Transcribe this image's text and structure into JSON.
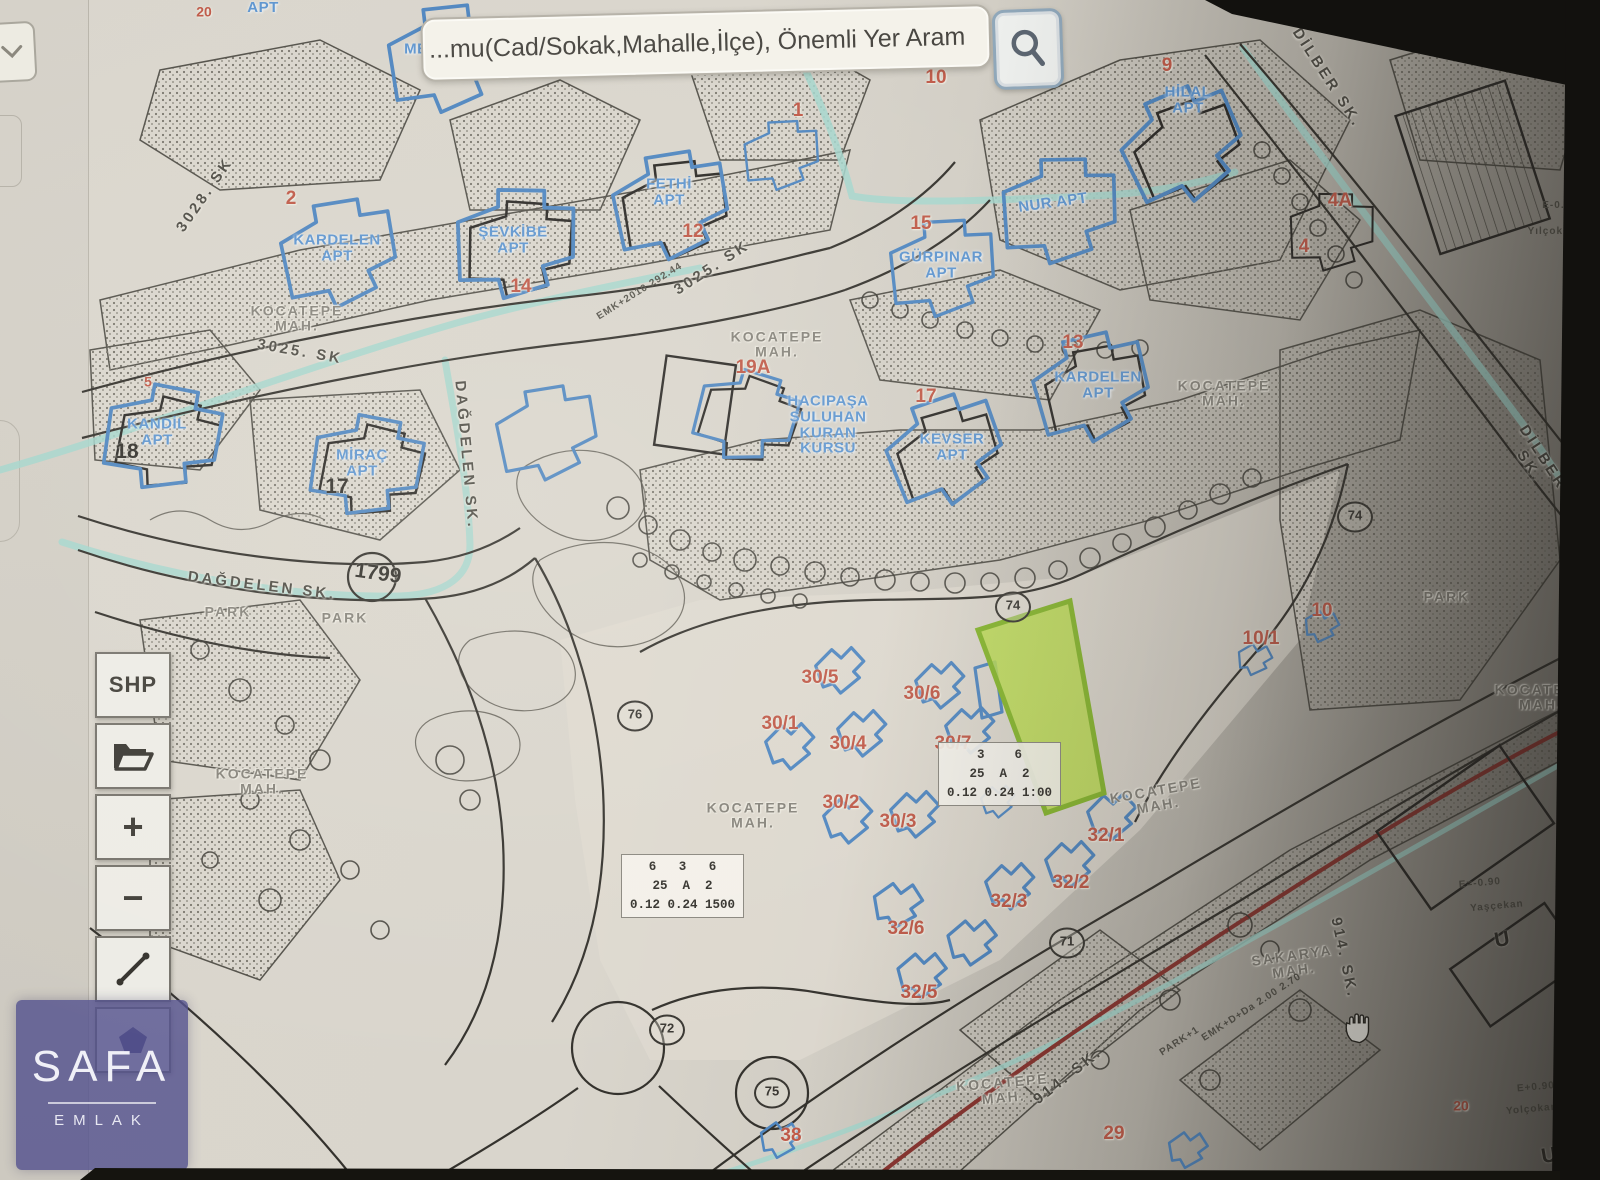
{
  "search": {
    "value": "...mu(Cad/Sokak,Mahalle,İlçe), Önemli Yer Aram",
    "button_icon": "magnifier-icon"
  },
  "corner_button": {
    "icon": "chevron-down-icon"
  },
  "toolbar": {
    "buttons": [
      {
        "id": "shp",
        "label": "SHP"
      },
      {
        "id": "open-layer",
        "icon": "folder-icon"
      },
      {
        "id": "zoom-in",
        "label": "+"
      },
      {
        "id": "zoom-out",
        "label": "−"
      },
      {
        "id": "measure",
        "icon": "ruler-icon"
      },
      {
        "id": "draw-polygon",
        "icon": "pentagon-icon"
      }
    ]
  },
  "watermark": {
    "title": "SAFA",
    "subtitle": "EMLAK"
  },
  "map": {
    "highlight_parcel": {
      "fill": "#b9dc4e",
      "border": "#85b52c"
    },
    "colors": {
      "apt_label": "#5e95cf",
      "parcel_label": "#bf5948",
      "street_label": "#4e4c45",
      "mah_label": "#86837b",
      "water": "#a5d6cc",
      "road_red": "#8a3530"
    },
    "legend_boxes": [
      {
        "x": 683,
        "y": 888,
        "rows": "6   3   6\n25  A  2\n0.12 0.24 1500"
      },
      {
        "x": 1000,
        "y": 776,
        "rows": "3    6\n25  A  2\n0.12 0.24 1:00"
      }
    ],
    "labels": [
      {
        "text": "3028. SK",
        "x": 205,
        "y": 195,
        "r": -55,
        "type": "street"
      },
      {
        "text": "3025. SK",
        "x": 300,
        "y": 352,
        "r": 10,
        "type": "street"
      },
      {
        "text": "3025. SK",
        "x": 712,
        "y": 268,
        "r": -33,
        "type": "street"
      },
      {
        "text": "DAĞDELEN SK.",
        "x": 466,
        "y": 455,
        "r": 85,
        "type": "street"
      },
      {
        "text": "DAĞDELEN SK.",
        "x": 262,
        "y": 586,
        "r": 7,
        "type": "street"
      },
      {
        "text": "DİLBER SK.",
        "x": 1327,
        "y": 78,
        "r": 57,
        "type": "street"
      },
      {
        "text": "DİLBER SK.",
        "x": 1536,
        "y": 462,
        "r": 57,
        "type": "street"
      },
      {
        "text": "914. SK.",
        "x": 1068,
        "y": 1076,
        "r": -38,
        "type": "street"
      },
      {
        "text": "914. SK.",
        "x": 1344,
        "y": 958,
        "r": 78,
        "type": "street"
      },
      {
        "text": "KOCATEPE\nMAH.",
        "x": 297,
        "y": 318,
        "r": 0,
        "type": "mah"
      },
      {
        "text": "KOCATEPE\nMAH.",
        "x": 777,
        "y": 344,
        "r": 0,
        "type": "mah"
      },
      {
        "text": "KOCATEPE\nMAH.",
        "x": 1224,
        "y": 393,
        "r": 0,
        "type": "mah"
      },
      {
        "text": "KOCATEPE\nMAH.",
        "x": 262,
        "y": 781,
        "r": 0,
        "type": "mah"
      },
      {
        "text": "KOCATEPE\nMAH.",
        "x": 753,
        "y": 815,
        "r": 0,
        "type": "mah"
      },
      {
        "text": "KOCATEPE\nMAH.",
        "x": 1157,
        "y": 798,
        "r": -10,
        "type": "mah"
      },
      {
        "text": "KOCATEPE\nMAH.",
        "x": 1003,
        "y": 1090,
        "r": -5,
        "type": "mah"
      },
      {
        "text": "KOCATEPE\nMAH.",
        "x": 1541,
        "y": 697,
        "r": 0,
        "type": "mah"
      },
      {
        "text": "SAKARYA\nMAH.",
        "x": 1293,
        "y": 963,
        "r": -8,
        "type": "mah"
      },
      {
        "text": "PARK",
        "x": 228,
        "y": 612,
        "r": 0,
        "type": "mah"
      },
      {
        "text": "PARK",
        "x": 345,
        "y": 618,
        "r": 0,
        "type": "mah"
      },
      {
        "text": "PARK",
        "x": 1447,
        "y": 597,
        "r": 0,
        "type": "mah"
      },
      {
        "text": "MENEKŞE\nAPT",
        "x": 443,
        "y": 57,
        "r": 0,
        "type": "apt"
      },
      {
        "text": "APT",
        "x": 263,
        "y": 8,
        "r": 0,
        "type": "apt"
      },
      {
        "text": "KARDELEN\nAPT",
        "x": 337,
        "y": 248,
        "r": 0,
        "type": "apt"
      },
      {
        "text": "ŞEVKİBE\nAPT",
        "x": 513,
        "y": 240,
        "r": 0,
        "type": "apt"
      },
      {
        "text": "FETHİ\nAPT",
        "x": 669,
        "y": 192,
        "r": 0,
        "type": "apt"
      },
      {
        "text": "GÜRPINAR\nAPT",
        "x": 941,
        "y": 265,
        "r": 0,
        "type": "apt"
      },
      {
        "text": "NUR APT",
        "x": 1053,
        "y": 203,
        "r": -8,
        "type": "apt"
      },
      {
        "text": "HİLAL\nAPT",
        "x": 1188,
        "y": 100,
        "r": 0,
        "type": "apt"
      },
      {
        "text": "KANDİL\nAPT",
        "x": 157,
        "y": 432,
        "r": 0,
        "type": "apt"
      },
      {
        "text": "MİRAÇ\nAPT",
        "x": 362,
        "y": 463,
        "r": 0,
        "type": "apt"
      },
      {
        "text": "KEVSER\nAPT",
        "x": 952,
        "y": 447,
        "r": 0,
        "type": "apt"
      },
      {
        "text": "KARDELEN\nAPT",
        "x": 1098,
        "y": 385,
        "r": 0,
        "type": "apt"
      },
      {
        "text": "HACIPAŞA\nSULUHAN\nKURAN\nKURSU",
        "x": 828,
        "y": 425,
        "r": 0,
        "type": "apt"
      },
      {
        "text": "2",
        "x": 291,
        "y": 199,
        "r": 0,
        "type": "parcel"
      },
      {
        "text": "14",
        "x": 521,
        "y": 287,
        "r": 0,
        "type": "parcel"
      },
      {
        "text": "12",
        "x": 693,
        "y": 232,
        "r": 0,
        "type": "parcel"
      },
      {
        "text": "1",
        "x": 798,
        "y": 111,
        "r": 0,
        "type": "parcel"
      },
      {
        "text": "10",
        "x": 936,
        "y": 78,
        "r": 0,
        "type": "parcel"
      },
      {
        "text": "15",
        "x": 921,
        "y": 224,
        "r": 0,
        "type": "parcel"
      },
      {
        "text": "9",
        "x": 1167,
        "y": 66,
        "r": 0,
        "type": "parcel"
      },
      {
        "text": "4A",
        "x": 1340,
        "y": 201,
        "r": 0,
        "type": "parcel"
      },
      {
        "text": "4",
        "x": 1304,
        "y": 247,
        "r": 0,
        "type": "parcel"
      },
      {
        "text": "13",
        "x": 1073,
        "y": 343,
        "r": 0,
        "type": "parcel"
      },
      {
        "text": "17",
        "x": 926,
        "y": 397,
        "r": 0,
        "type": "parcel"
      },
      {
        "text": "19A",
        "x": 753,
        "y": 368,
        "r": 0,
        "type": "parcel"
      },
      {
        "text": "5",
        "x": 148,
        "y": 382,
        "r": 0,
        "type": "parcel-sm"
      },
      {
        "text": "20",
        "x": 204,
        "y": 12,
        "r": 0,
        "type": "parcel-sm"
      },
      {
        "text": "30/5",
        "x": 820,
        "y": 678,
        "r": 0,
        "type": "parcel"
      },
      {
        "text": "30/6",
        "x": 922,
        "y": 694,
        "r": 0,
        "type": "parcel"
      },
      {
        "text": "30/1",
        "x": 780,
        "y": 724,
        "r": 0,
        "type": "parcel"
      },
      {
        "text": "30/4",
        "x": 848,
        "y": 744,
        "r": 0,
        "type": "parcel"
      },
      {
        "text": "30/7",
        "x": 953,
        "y": 744,
        "r": 0,
        "type": "parcel"
      },
      {
        "text": "30/2",
        "x": 841,
        "y": 803,
        "r": 0,
        "type": "parcel"
      },
      {
        "text": "30/3",
        "x": 898,
        "y": 822,
        "r": 0,
        "type": "parcel"
      },
      {
        "text": "32/1",
        "x": 1106,
        "y": 836,
        "r": 0,
        "type": "parcel"
      },
      {
        "text": "32/2",
        "x": 1071,
        "y": 883,
        "r": 0,
        "type": "parcel"
      },
      {
        "text": "32/3",
        "x": 1009,
        "y": 902,
        "r": 0,
        "type": "parcel"
      },
      {
        "text": "32/6",
        "x": 906,
        "y": 929,
        "r": 0,
        "type": "parcel"
      },
      {
        "text": "32/5",
        "x": 919,
        "y": 993,
        "r": 0,
        "type": "parcel"
      },
      {
        "text": "38",
        "x": 791,
        "y": 1136,
        "r": 0,
        "type": "parcel"
      },
      {
        "text": "29",
        "x": 1114,
        "y": 1134,
        "r": 0,
        "type": "parcel"
      },
      {
        "text": "10",
        "x": 1322,
        "y": 611,
        "r": 0,
        "type": "parcel"
      },
      {
        "text": "10/1",
        "x": 1261,
        "y": 639,
        "r": 0,
        "type": "parcel"
      },
      {
        "text": "20",
        "x": 1461,
        "y": 1106,
        "r": 0,
        "type": "parcel-sm"
      },
      {
        "text": "18",
        "x": 127,
        "y": 452,
        "r": 0,
        "type": "num"
      },
      {
        "text": "17",
        "x": 337,
        "y": 487,
        "r": 0,
        "type": "num"
      },
      {
        "text": "12",
        "x": 1570,
        "y": 545,
        "r": 75,
        "type": "num"
      },
      {
        "text": "1799",
        "x": 378,
        "y": 574,
        "r": 8,
        "type": "num"
      },
      {
        "text": "U",
        "x": 1502,
        "y": 940,
        "r": -10,
        "type": "num"
      },
      {
        "text": "U",
        "x": 1549,
        "y": 1156,
        "r": -10,
        "type": "num"
      },
      {
        "text": "74",
        "x": 1355,
        "y": 517,
        "r": 0,
        "type": "circ"
      },
      {
        "text": "74",
        "x": 1013,
        "y": 607,
        "r": 0,
        "type": "circ"
      },
      {
        "text": "76",
        "x": 635,
        "y": 716,
        "r": 0,
        "type": "circ"
      },
      {
        "text": "72",
        "x": 667,
        "y": 1030,
        "r": 0,
        "type": "circ"
      },
      {
        "text": "71",
        "x": 1067,
        "y": 943,
        "r": 0,
        "type": "circ"
      },
      {
        "text": "75",
        "x": 772,
        "y": 1093,
        "r": 0,
        "type": "circ"
      },
      {
        "text": "EMK+2010 292.44",
        "x": 640,
        "y": 292,
        "r": -32,
        "type": "tiny"
      },
      {
        "text": "EMK+D+Da 2.00 2.70",
        "x": 1252,
        "y": 1008,
        "r": -33,
        "type": "tiny"
      },
      {
        "text": "PARK+1",
        "x": 1180,
        "y": 1042,
        "r": -33,
        "type": "tiny"
      },
      {
        "text": "E-0.90",
        "x": 1560,
        "y": 206,
        "r": 0,
        "type": "tiny"
      },
      {
        "text": "Yılçok+4",
        "x": 1552,
        "y": 232,
        "r": 0,
        "type": "tiny"
      },
      {
        "text": "E=-0.90",
        "x": 1480,
        "y": 884,
        "r": -5,
        "type": "tiny"
      },
      {
        "text": "Yaşçekan",
        "x": 1497,
        "y": 907,
        "r": -5,
        "type": "tiny"
      },
      {
        "text": "E+0.90",
        "x": 1536,
        "y": 1088,
        "r": -5,
        "type": "tiny"
      },
      {
        "text": "Yolçokan",
        "x": 1532,
        "y": 1110,
        "r": -5,
        "type": "tiny"
      }
    ]
  }
}
